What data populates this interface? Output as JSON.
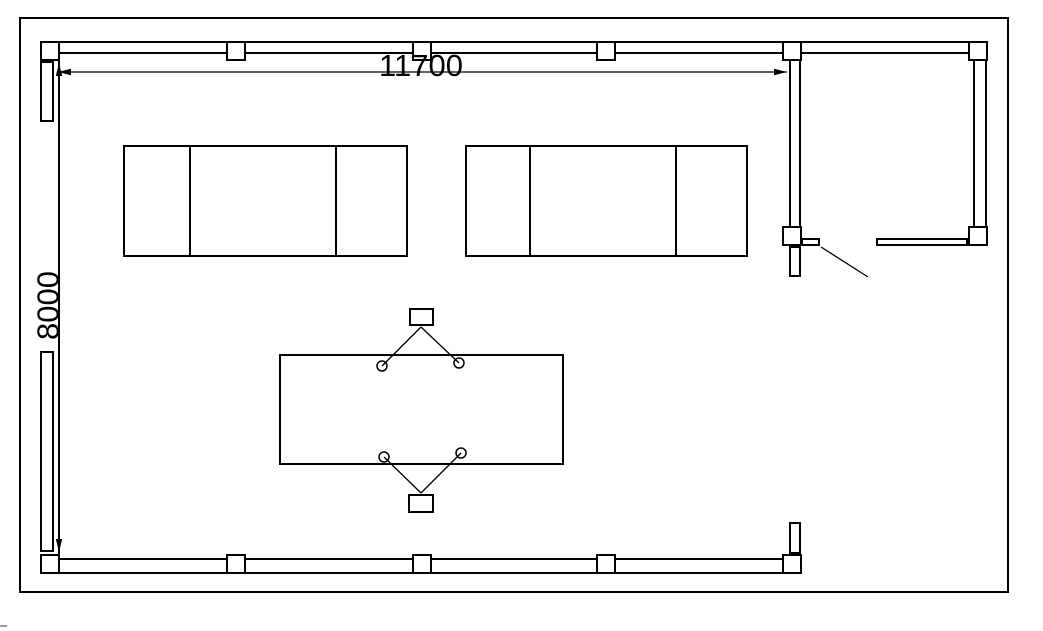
{
  "meta": {
    "drawing_type": "cad-floor-plan",
    "background_color": "#ffffff",
    "line_color": "#000000"
  },
  "dimensions": {
    "width_label": "11700",
    "height_label": "8000"
  }
}
